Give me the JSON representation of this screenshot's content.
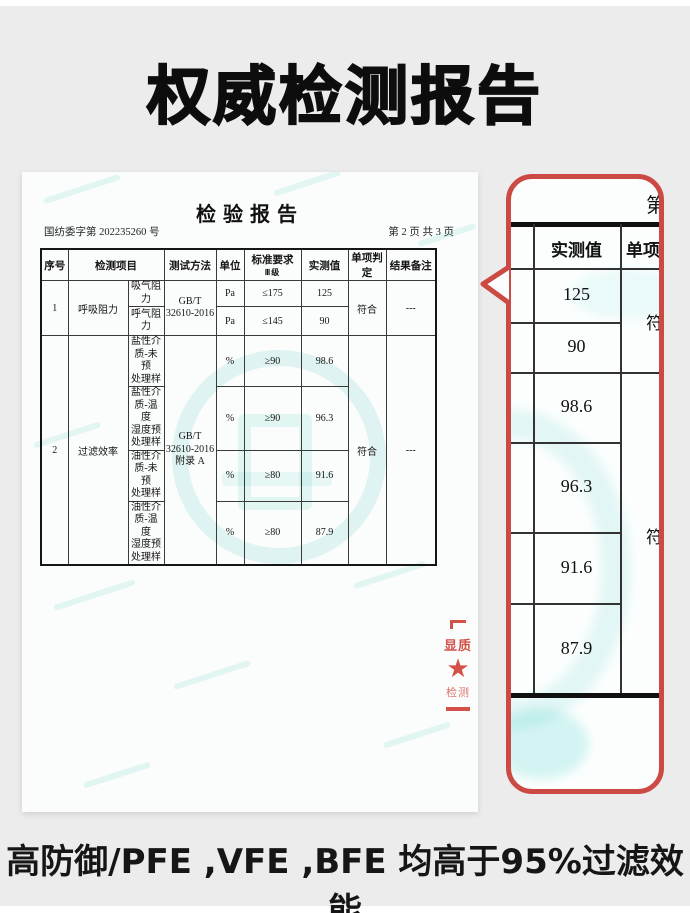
{
  "colors": {
    "background_gray": "#ececec",
    "callout_red": "#cc4a44",
    "stamp_red": "#cf3a31",
    "watermark_cyan": "#00afa5",
    "title_black": "#0d0d0d"
  },
  "banner": {
    "title": "权威检测报告"
  },
  "report": {
    "title": "检验报告",
    "doc_number": "国纺委字第 202235260 号",
    "page_indicator": "第 2 页  共 3 页",
    "table": {
      "headers": {
        "index": "序号",
        "item": "检测项目",
        "method": "测试方法",
        "unit": "单位",
        "requirement": "标准要求",
        "requirement_level": "Ⅲ级",
        "measured": "实测值",
        "judgement": "单项判定",
        "remark": "结果备注"
      },
      "groups": [
        {
          "index": "1",
          "item": "呼吸阻力",
          "method": "GB/T\n32610-2016",
          "judgement": "符合",
          "remark": "---",
          "rows": [
            {
              "sub_item": "吸气阻\n力",
              "unit": "Pa",
              "requirement": "≤175",
              "measured": "125"
            },
            {
              "sub_item": "呼气阻\n力",
              "unit": "Pa",
              "requirement": "≤145",
              "measured": "90"
            }
          ]
        },
        {
          "index": "2",
          "item": "过滤效率",
          "method": "GB/T\n32610-2016\n附录 A",
          "judgement": "符合",
          "remark": "---",
          "rows": [
            {
              "sub_item": "盐性介\n质-未预\n处理样",
              "unit": "%",
              "requirement": "≥90",
              "measured": "98.6"
            },
            {
              "sub_item": "盐性介\n质-温度\n湿度预\n处理样",
              "unit": "%",
              "requirement": "≥90",
              "measured": "96.3"
            },
            {
              "sub_item": "油性介\n质-未预\n处理样",
              "unit": "%",
              "requirement": "≥80",
              "measured": "91.6"
            },
            {
              "sub_item": "油性介\n质-温度\n湿度预\n处理样",
              "unit": "%",
              "requirement": "≥80",
              "measured": "87.9"
            }
          ]
        }
      ]
    },
    "stamp": {
      "text_top": "显质",
      "star": "★",
      "text_bottom": "检测"
    }
  },
  "callout": {
    "page_char": "第",
    "col_measured": "实测值",
    "col_judgement_partial": "单项",
    "judgement_char": "符",
    "values": [
      "125",
      "90",
      "98.6",
      "96.3",
      "91.6",
      "87.9"
    ]
  },
  "caption": {
    "text": "高防御/PFE ,VFE ,BFE 均高于95%过滤效能"
  }
}
